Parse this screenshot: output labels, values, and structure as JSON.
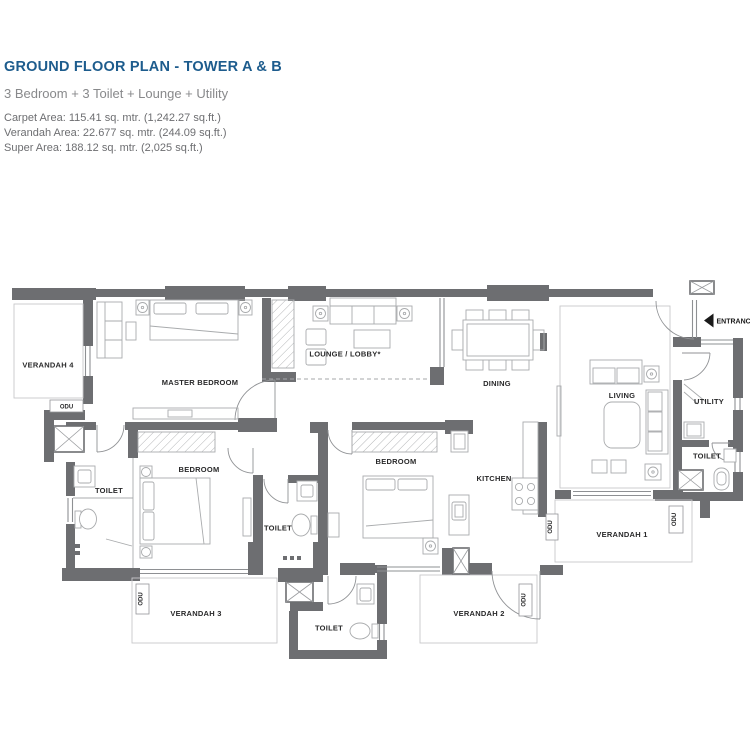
{
  "header": {
    "title": "GROUND FLOOR PLAN - TOWER A & B",
    "subtitle": "3 Bedroom + 3 Toilet + Lounge + Utility",
    "carpet_area": "Carpet Area: 115.41 sq. mtr. (1,242.27 sq.ft.)",
    "verandah_area": "Verandah Area: 22.677 sq. mtr. (244.09 sq.ft.)",
    "super_area": "Super Area: 188.12 sq. mtr. (2,025 sq.ft.)"
  },
  "plan": {
    "rooms": {
      "master_bedroom": "MASTER BEDROOM",
      "bedroom": "BEDROOM",
      "toilet": "TOILET",
      "lounge": "LOUNGE / LOBBY*",
      "dining": "DINING",
      "living": "LIVING",
      "kitchen": "KITCHEN",
      "utility": "UTILITY",
      "verandah1": "VERANDAH 1",
      "verandah2": "VERANDAH 2",
      "verandah3": "VERANDAH 3",
      "verandah4": "VERANDAH 4",
      "odu": "ODU",
      "entrance": "ENTRANCE"
    },
    "colors": {
      "wall": "#6d6e71",
      "title_accent": "#1d5c8d",
      "label": "#29292a"
    }
  }
}
